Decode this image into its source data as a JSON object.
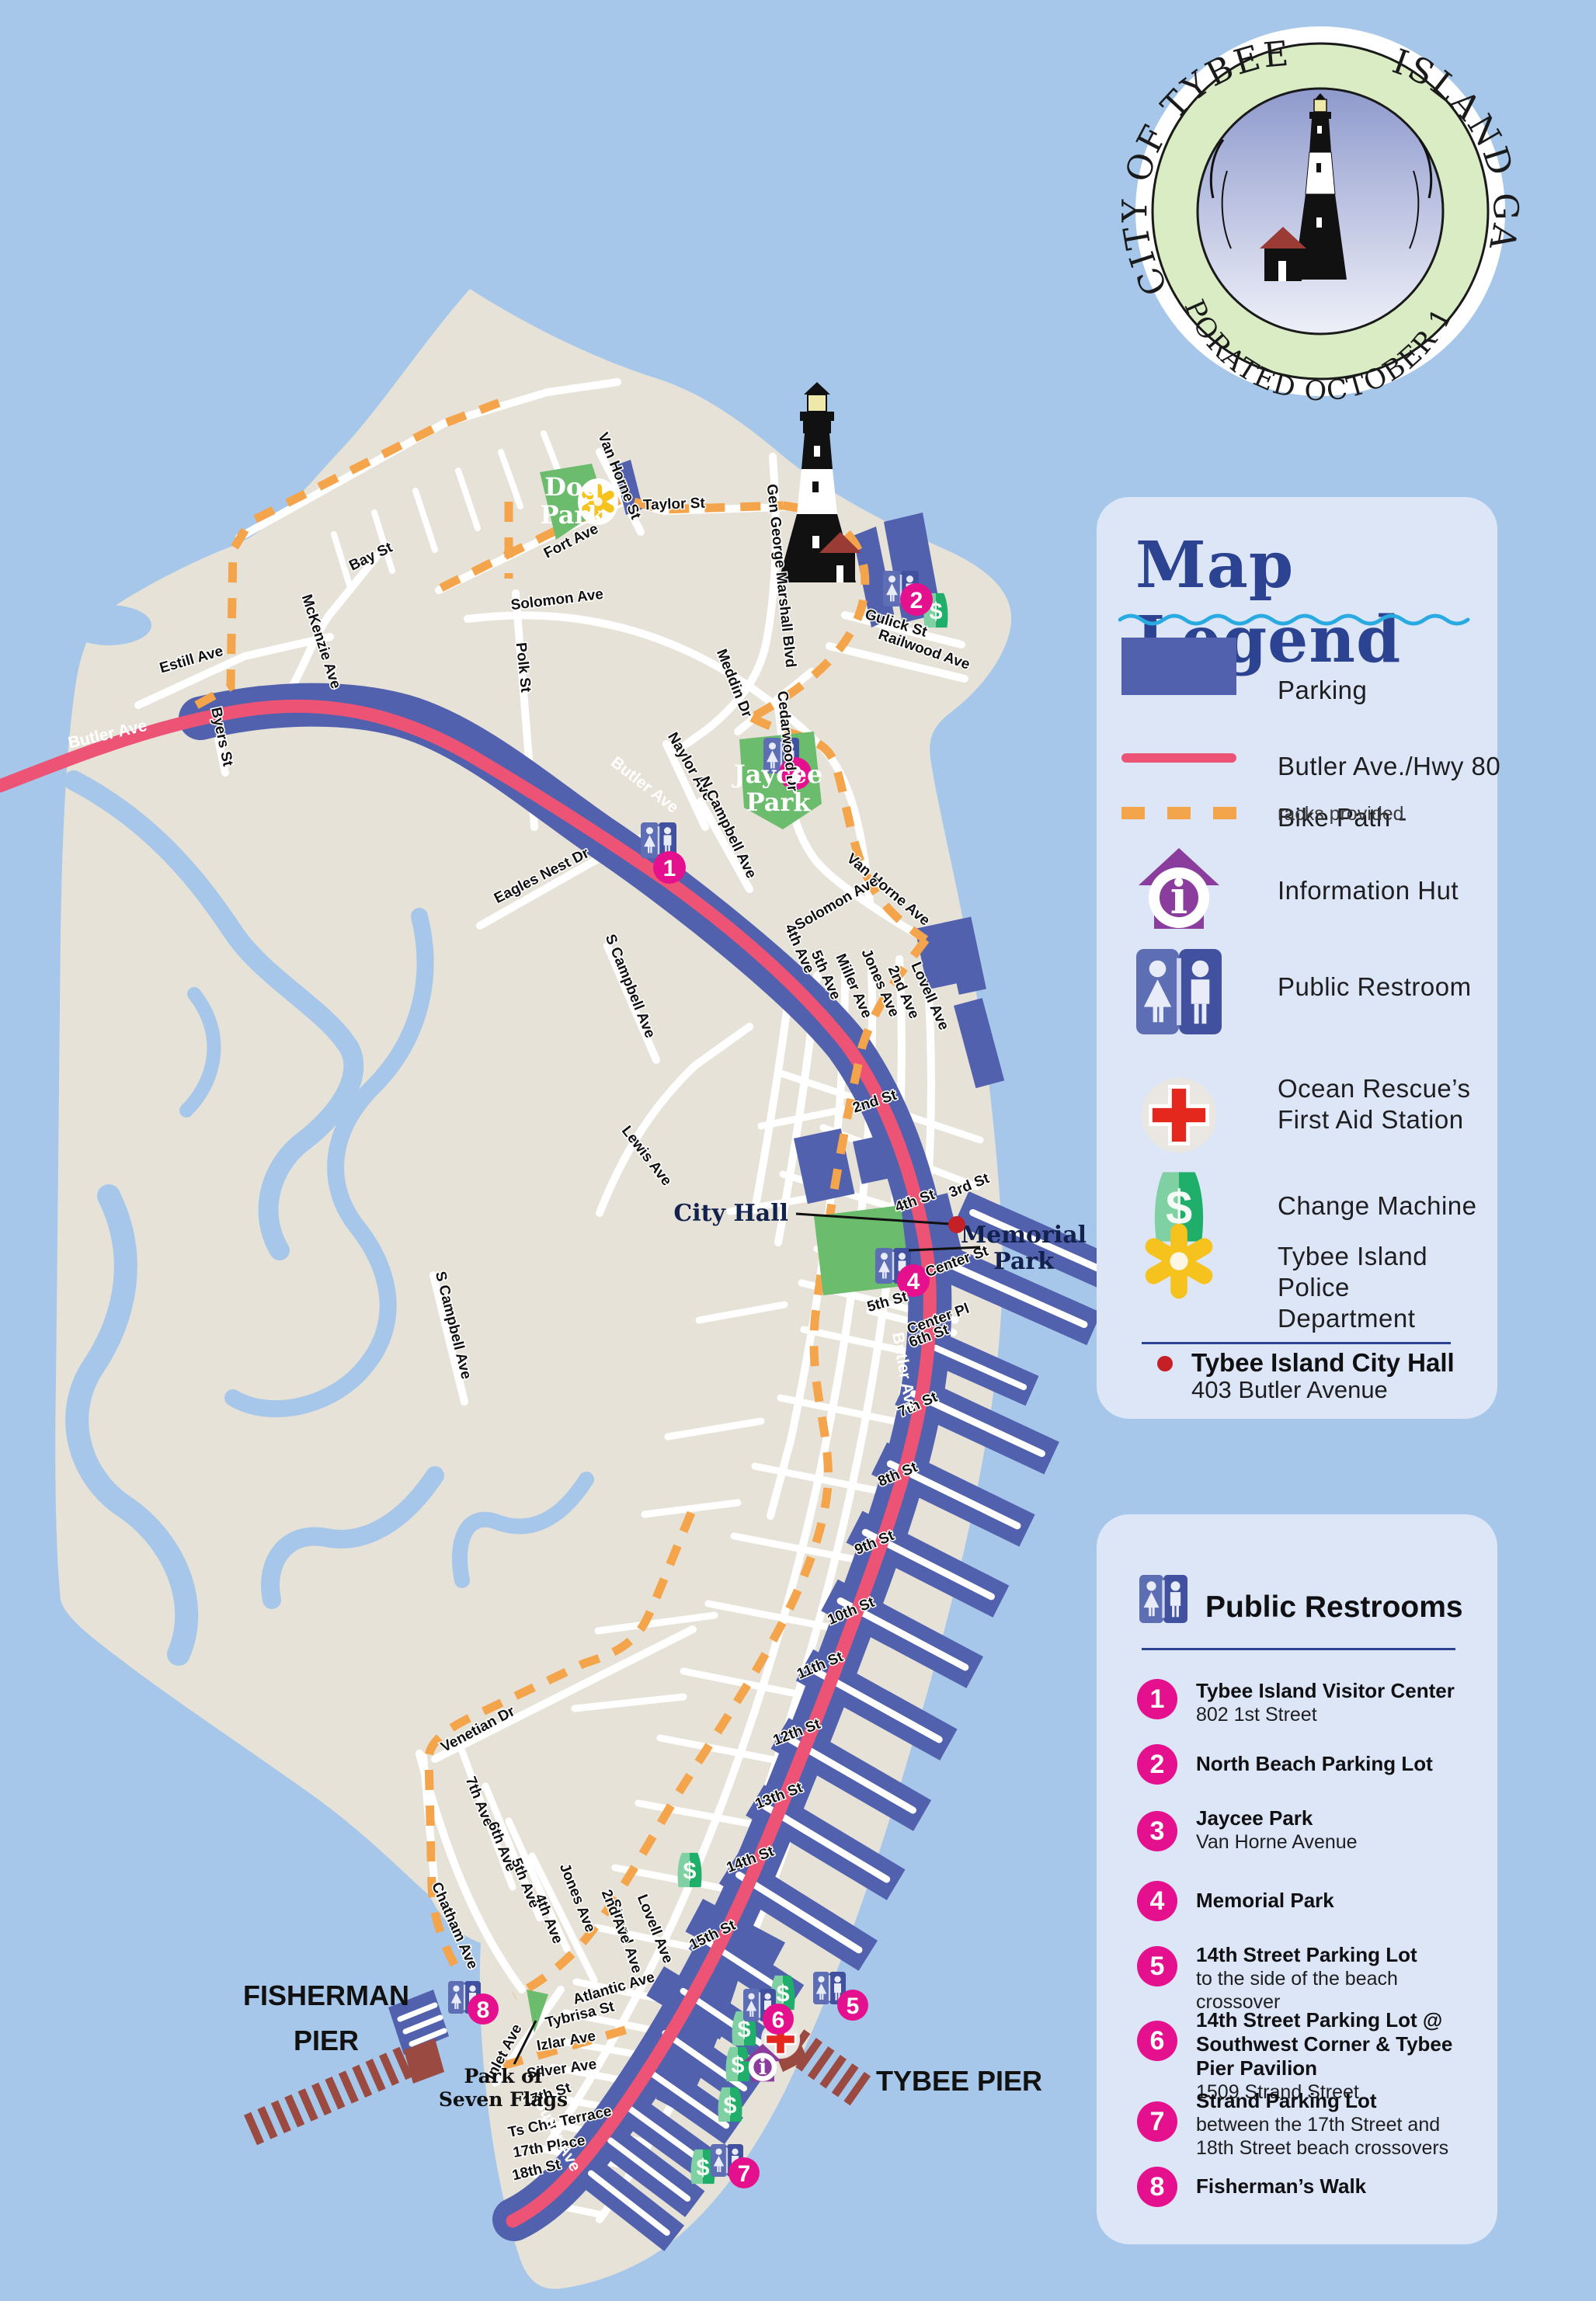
{
  "seal": {
    "arc_top_left": "CITY OF TYBEE",
    "arc_top_right": "ISLAND GA",
    "arc_bottom": "INCORPORATED OCTOBER 15, 1887"
  },
  "legend": {
    "title": "Map Legend",
    "items": {
      "parking": "Parking",
      "butler": "Butler Ave./Hwy 80",
      "bike": "Bike Path -",
      "bike_note": "racks provided",
      "info": "Information Hut",
      "restroom": "Public Restroom",
      "aid1": "Ocean Rescue’s",
      "aid2": "First Aid Station",
      "change": "Change Machine",
      "police1": "Tybee Island",
      "police2": "Police Department"
    },
    "cityhall_title": "Tybee Island City Hall",
    "cityhall_addr": "403 Butler Avenue"
  },
  "restrooms": {
    "title": "Public Restrooms",
    "items": [
      {
        "n": "1",
        "title": "Tybee Island Visitor Center",
        "desc": "802 1st Street"
      },
      {
        "n": "2",
        "title": "North Beach Parking Lot",
        "desc": ""
      },
      {
        "n": "3",
        "title": "Jaycee Park",
        "desc": "Van Horne Avenue"
      },
      {
        "n": "4",
        "title": "Memorial Park",
        "desc": ""
      },
      {
        "n": "5",
        "title": "14th Street Parking Lot",
        "desc": "to the side of the beach crossover"
      },
      {
        "n": "6",
        "title": "14th Street Parking Lot @ Southwest Corner & Tybee Pier Pavilion",
        "desc": "1509 Strand Street"
      },
      {
        "n": "7",
        "title": "Strand Parking Lot",
        "desc": "between the 17th Street and 18th Street beach crossovers"
      },
      {
        "n": "8",
        "title": "Fisherman’s Walk",
        "desc": ""
      }
    ]
  },
  "map": {
    "road_label": "Butler Ave",
    "dollar": "$",
    "info_i": "i",
    "markers": [
      "1",
      "2",
      "3",
      "4",
      "5",
      "6",
      "7",
      "8"
    ],
    "pois": {
      "city_hall": "City Hall",
      "memorial1": "Memorial",
      "memorial2": "Park",
      "dog1": "Dog",
      "dog2": "Park",
      "jaycee1": "Jaycee",
      "jaycee2": "Park",
      "flags1": "Park of",
      "flags2": "Seven Flags",
      "fisherman1": "FISHERMAN",
      "fisherman2": "PIER",
      "tybee_pier": "TYBEE PIER"
    },
    "street_labels": [
      "Estill Ave",
      "Byers St",
      "McKenzie Ave",
      "Polk St",
      "Bay St",
      "Fort Ave",
      "Van Horne St",
      "Taylor St",
      "Solomon Ave",
      "Gen George Marshall Blvd",
      "Meddin Dr",
      "Gulick St",
      "Railwood Ave",
      "Cedarwood Dr",
      "Van Horne Ave",
      "Naylor Ave",
      "N Campbell Ave",
      "S Campbell Ave",
      "S Campbell Ave",
      "Eagles Nest Dr",
      "Solomon Ave",
      "4th Ave",
      "5th Ave",
      "Miller Ave",
      "Jones Ave",
      "2nd Ave",
      "Lovell Ave",
      "Lewis Ave",
      "2nd St",
      "3rd St",
      "4th St",
      "Center St",
      "5th St",
      "Center Pl",
      "6th St",
      "7th St",
      "8th St",
      "9th St",
      "10th St",
      "11th St",
      "12th St",
      "13th St",
      "14th St",
      "15th St",
      "Atlantic Ave",
      "Tybrisa St",
      "Izlar Ave",
      "Silver Ave",
      "17th St",
      "Ts Chu Terrace",
      "17th Place",
      "18th St",
      "Strand Ave",
      "Chatham Ave",
      "Venetian Dr",
      "Inlet Ave",
      "7th Ave",
      "6th Ave",
      "5th Ave",
      "4th Ave",
      "Jones Ave",
      "2nd Ave",
      "Lovell Ave"
    ]
  },
  "colors": {
    "ocean": "#a6c7e9",
    "land": "#e7e2d8",
    "parking": "#5161ad",
    "butler": "#ec5375",
    "bike": "#f4a44b",
    "park": "#6cbc6e",
    "pier": "#9a4a40",
    "panel": "#dce6f6",
    "navy": "#2b4390",
    "magenta": "#e5108d",
    "wave": "#29abe2"
  }
}
